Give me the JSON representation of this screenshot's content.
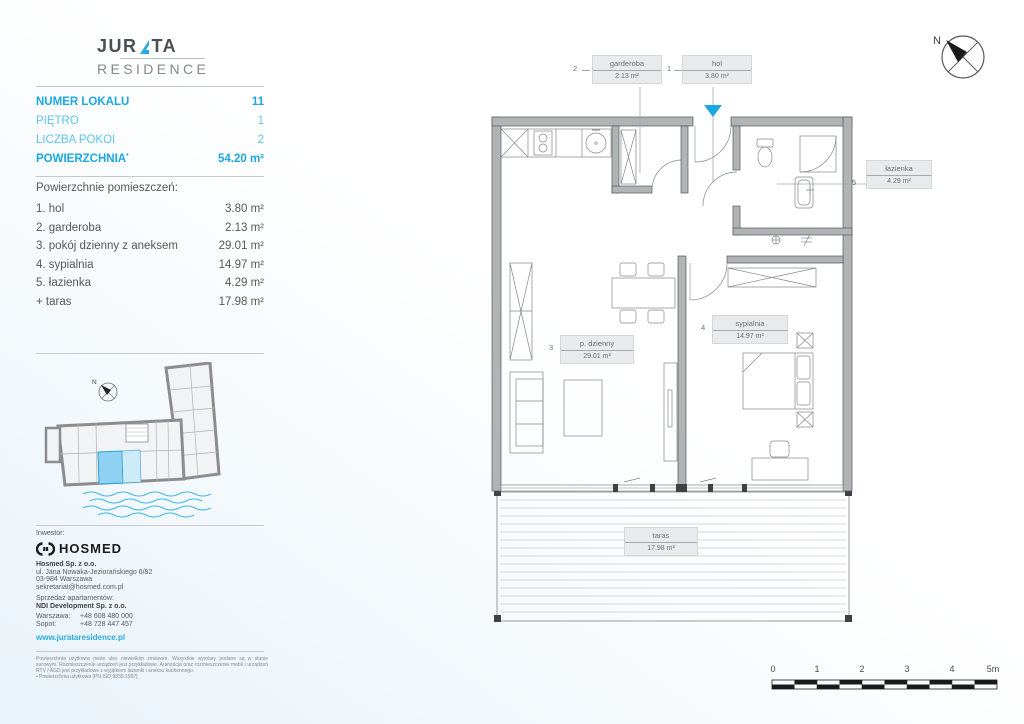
{
  "colors": {
    "accent": "#29abe2",
    "accent_bold": "#1ba7e0",
    "accent_light": "#5fc5ec",
    "wall": "#b2b3b5",
    "highlight": "#8ed1f2"
  },
  "brand": {
    "top1": "JUR",
    "top2": "TA",
    "bottom": "RESIDENCE",
    "sail_icon": "sail-icon"
  },
  "summary": {
    "rows": [
      {
        "label": "NUMER LOKALU",
        "value": "11"
      },
      {
        "label": "PIĘTRO",
        "value": "1"
      },
      {
        "label": "LICZBA POKOI",
        "value": "2"
      },
      {
        "label": "POWIERZCHNIA",
        "sup": "•",
        "value": "54.20 m²"
      }
    ]
  },
  "rooms": {
    "heading": "Powierzchnie pomieszczeń:",
    "items": [
      {
        "name": "1. hol",
        "area": "3.80 m²"
      },
      {
        "name": "2. garderoba",
        "area": "2.13 m²"
      },
      {
        "name": "3. pokój dzienny z aneksem",
        "area": "29.01 m²"
      },
      {
        "name": "4. sypialnia",
        "area": "14.97 m²"
      },
      {
        "name": "5. łazienka",
        "area": "4.29 m²"
      },
      {
        "name": "+ taras",
        "area": "17.98 m²"
      }
    ]
  },
  "sitemap": {
    "compass": "N"
  },
  "investor": {
    "heading": "Inwestor:",
    "brand": "HOSMED",
    "company": "Hosmed Sp. z o.o.",
    "address1": "ul. Jana Nowaka-Jeziorańskiego 6/82",
    "address2": "03-984 Warszawa",
    "email": "sekretariat@hosmed.com.pl",
    "sales_heading": "Sprzedaż apartamentów:",
    "sales_company": "NDI Development Sp. z o.o.",
    "phone1_label": "Warszawa:",
    "phone1": "+48 608 480 000",
    "phone2_label": "Sopot:",
    "phone2": "+48 728 447 457",
    "website": "www.jurataresidence.pl"
  },
  "legal": {
    "par1": "Powierzchnia użytkowa może ulec niewielkim zmianom. Wszystkie wymiary podane są w stanie surowym. Rozmieszczenie urządzeń jest przykładowe. Aranżacja oraz rozmieszczenie mebli i urządzeń RTV / AGD jest przykładowe z wyjątkiem łazienki i aneksu kuchennego.",
    "par2": "• Powierzchnia użytkowa [PN-ISO 9836:1997]"
  },
  "plan": {
    "compass": "N",
    "labels": [
      {
        "num": "2",
        "name": "garderoba",
        "area": "2.13 m²"
      },
      {
        "num": "1",
        "name": "hol",
        "area": "3.80 m²"
      },
      {
        "num": "5",
        "name": "łazienka",
        "area": "4.29 m²"
      },
      {
        "num": "3",
        "name": "p. dzienny",
        "area": "29.01 m²"
      },
      {
        "num": "4",
        "name": "sypialnia",
        "area": "14.97 m²"
      },
      {
        "num": "",
        "name": "taras",
        "area": "17.98 m²"
      }
    ]
  },
  "scalebar": {
    "labels": [
      "0",
      "1",
      "2",
      "3",
      "4",
      "5m"
    ]
  }
}
